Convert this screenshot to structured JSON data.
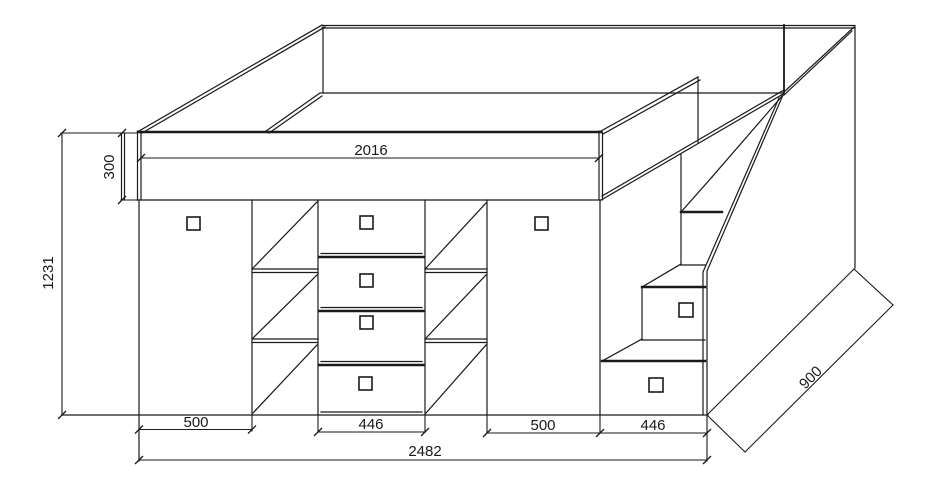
{
  "colors": {
    "ink": "#1a1a1a",
    "paper": "#ffffff"
  },
  "dims": {
    "bed_length": "2016",
    "bed_frame_height": "300",
    "cabinet_height": "1231",
    "left_door_width": "500",
    "drawer_block_width": "446",
    "right_door_width": "500",
    "stair_block_width": "446",
    "total_width": "2482",
    "depth": "900"
  }
}
